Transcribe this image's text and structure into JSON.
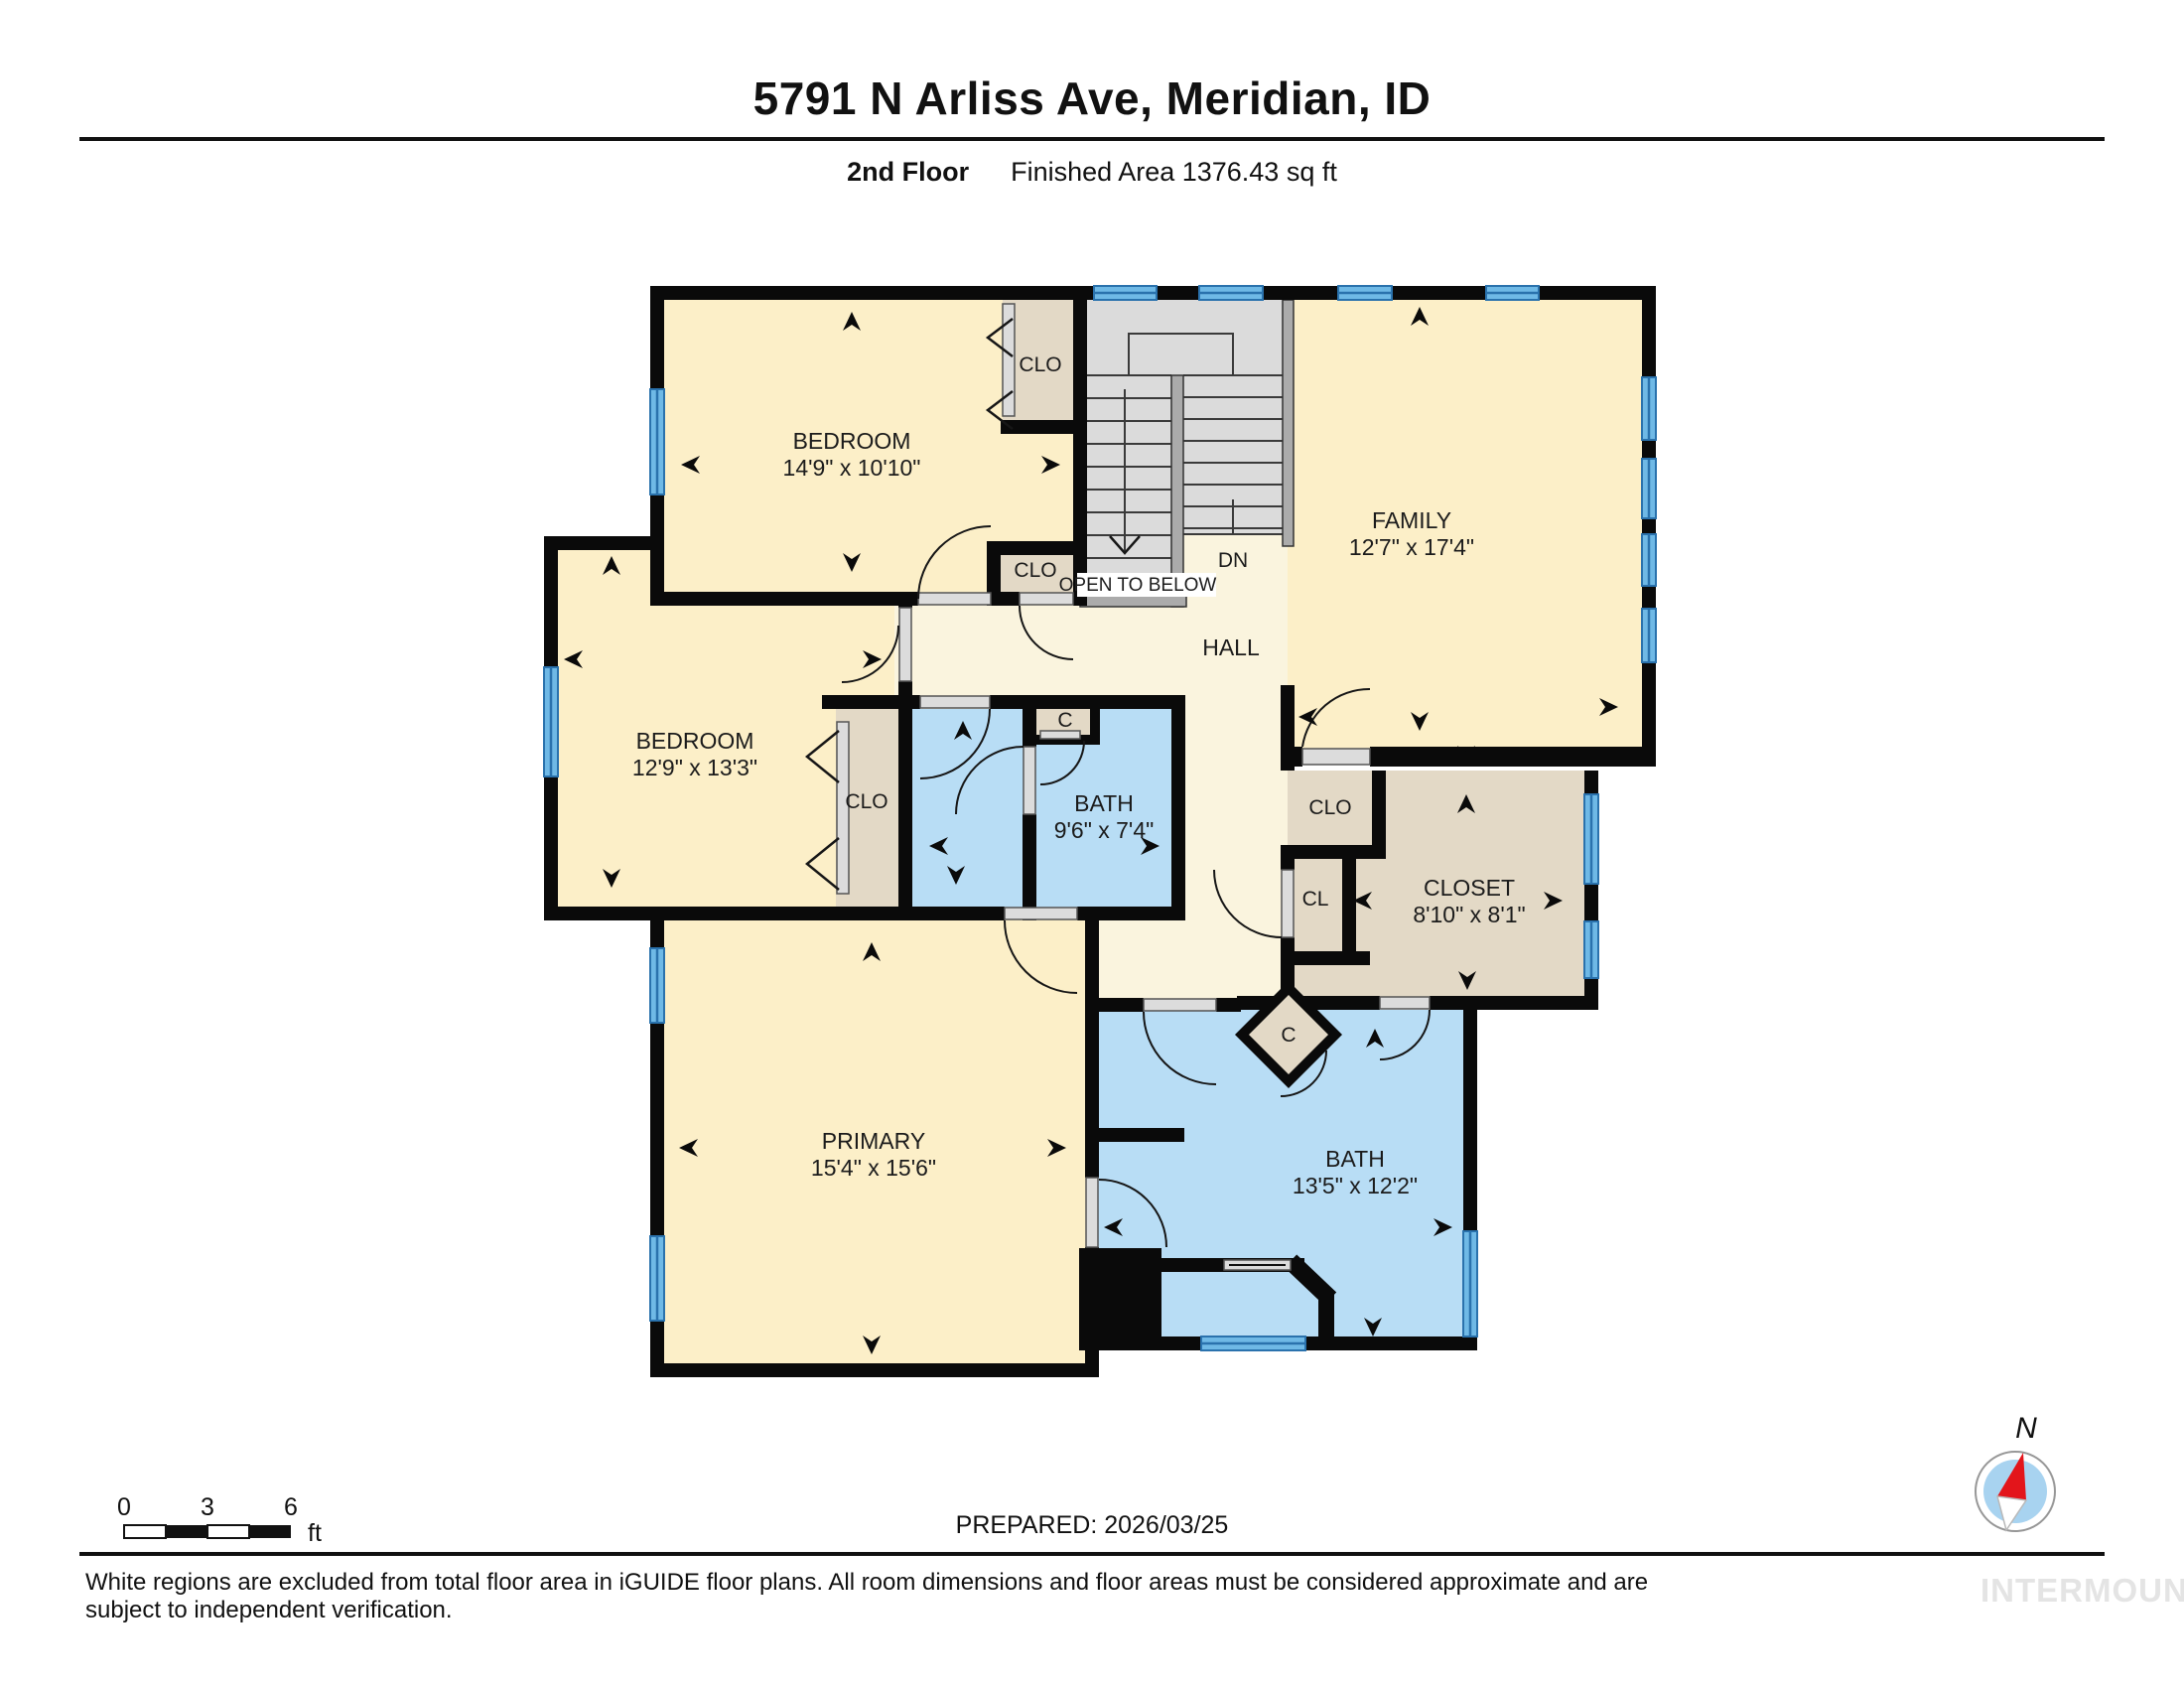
{
  "header": {
    "title": "5791 N Arliss Ave, Meridian, ID",
    "floor_label": "2nd Floor",
    "area_label": "Finished Area 1376.43 sq ft"
  },
  "rooms": {
    "bedroom_top": {
      "name": "BEDROOM",
      "dims": "14'9\" x 10'10\""
    },
    "bedroom_left": {
      "name": "BEDROOM",
      "dims": "12'9\" x 13'3\""
    },
    "family": {
      "name": "FAMILY",
      "dims": "12'7\" x 17'4\""
    },
    "primary": {
      "name": "PRIMARY",
      "dims": "15'4\" x 15'6\""
    },
    "bath_small": {
      "name": "BATH",
      "dims": "9'6\" x 7'4\""
    },
    "bath_large": {
      "name": "BATH",
      "dims": "13'5\" x 12'2\""
    },
    "closet": {
      "name": "CLOSET",
      "dims": "8'10\" x 8'1\""
    },
    "hall": {
      "name": "HALL"
    }
  },
  "labels": {
    "clo": "CLO",
    "cl": "CL",
    "c": "C",
    "dn": "DN",
    "open_to_below": "OPEN TO BELOW"
  },
  "scale_bar": {
    "zero": "0",
    "three": "3",
    "six": "6",
    "unit": "ft"
  },
  "compass": {
    "north": "N"
  },
  "footer": {
    "prepared": "PREPARED: 2026/03/25",
    "disclaimer": "White regions are excluded from total floor area in iGUIDE floor plans. All room dimensions and floor areas must be considered approximate and are subject to independent verification.",
    "watermark": "INTERMOUNTAIN"
  },
  "colors": {
    "wall": "#0a0a0a",
    "room_cream": "#FCEFC8",
    "hall_cream": "#FAF4DE",
    "closet_tan": "#E3D9C6",
    "bath_blue": "#B8DDF5",
    "stair_gray": "#DBDBDB",
    "window_blue": "#6FB9E6",
    "window_line": "#2A72AD",
    "compass_needle_red": "#E3151B",
    "compass_face_blue": "#A8D3F0",
    "watermark_gray": "#E4E4E4"
  }
}
